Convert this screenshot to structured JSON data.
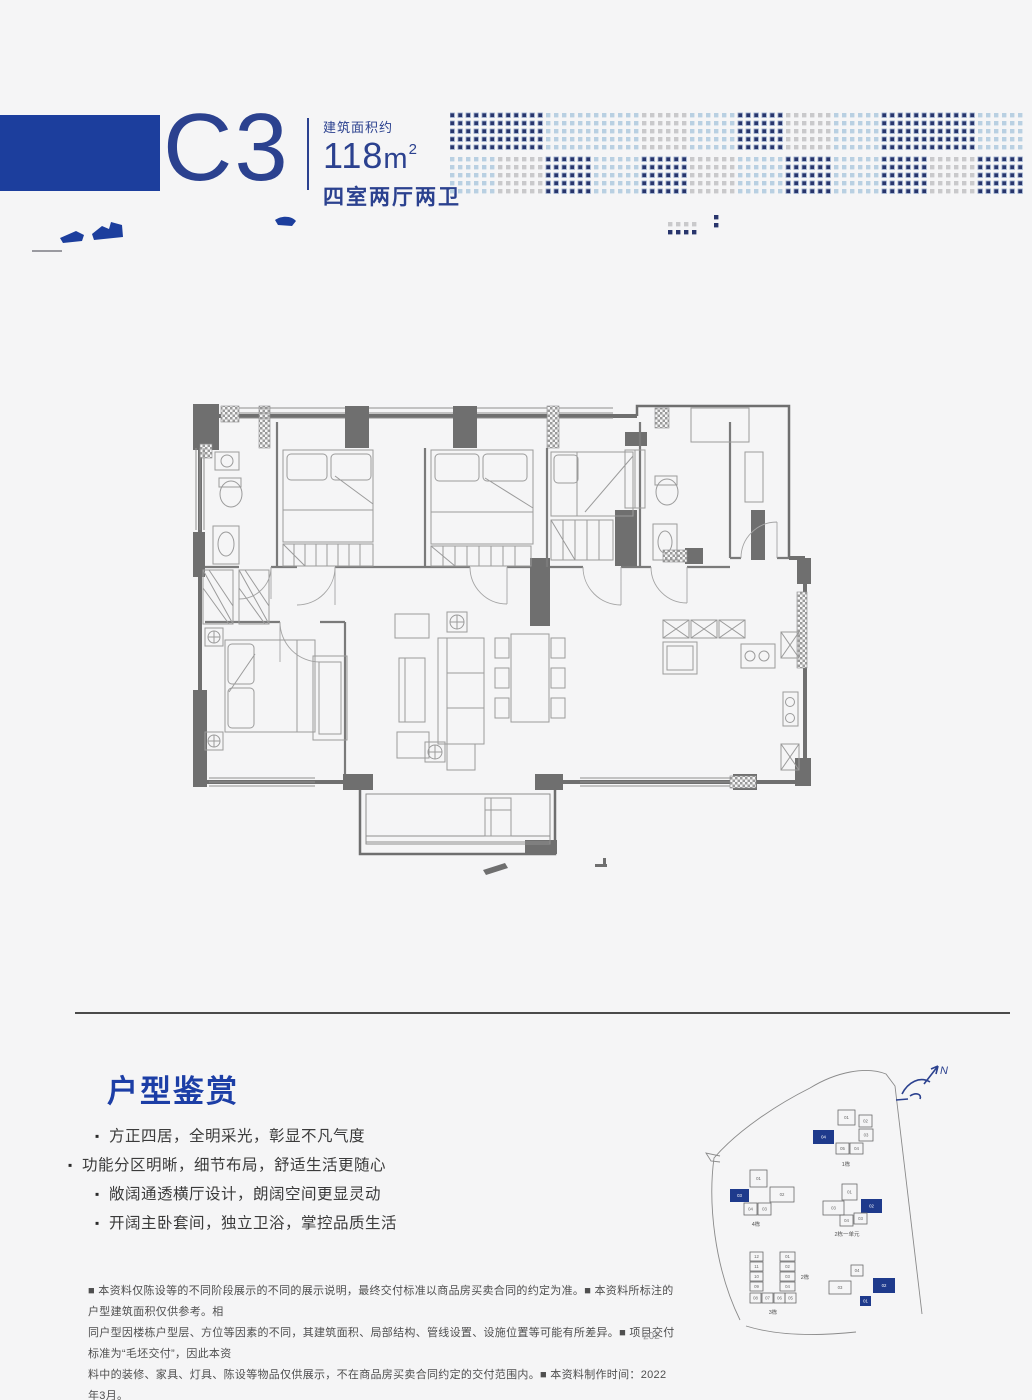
{
  "header": {
    "unit_code": "C3",
    "area_label": "建筑面积约",
    "area_value": "118",
    "area_unit": "m",
    "area_sup": "2",
    "layout_label": "四室两厅两卫",
    "banner_color": "#1c3e9d",
    "text_color": "#2b418f"
  },
  "decor": {
    "dot_dark": "#28356c",
    "dot_halo": "#93a7c9",
    "dot_blue": "#b9d0e2",
    "dot_gray": "#c9c9cb",
    "top_band": [
      "d",
      "d",
      "b",
      "b",
      "g",
      "b",
      "d",
      "g",
      "b",
      "d",
      "d",
      "b"
    ],
    "bottom_band": [
      "b",
      "g",
      "d",
      "b",
      "d",
      "g",
      "b",
      "d",
      "b",
      "d",
      "g",
      "d"
    ],
    "extra_dots": [
      {
        "x": 218,
        "y": 112,
        "c": "g"
      },
      {
        "x": 226,
        "y": 112,
        "c": "g"
      },
      {
        "x": 234,
        "y": 112,
        "c": "g"
      },
      {
        "x": 242,
        "y": 112,
        "c": "g"
      },
      {
        "x": 218,
        "y": 120,
        "c": "d"
      },
      {
        "x": 226,
        "y": 120,
        "c": "d"
      },
      {
        "x": 234,
        "y": 120,
        "c": "d"
      },
      {
        "x": 242,
        "y": 120,
        "c": "d"
      },
      {
        "x": 264,
        "y": 105,
        "c": "d"
      },
      {
        "x": 264,
        "y": 113,
        "c": "d"
      }
    ]
  },
  "appreciation": {
    "title": "户型鉴赏",
    "bullets": [
      "方正四居，全明采光，彰显不凡气度",
      "功能分区明晰，细节布局，舒适生活更随心",
      "敞阔通透横厅设计，朗阔空间更显灵动",
      "开阔主卧套间，独立卫浴，掌控品质生活"
    ]
  },
  "siteplan": {
    "north_label": "N",
    "outline_color": "#8a8a8a",
    "unit_stroke": "#6a6a6a",
    "unit_text_color": "#666666",
    "highlight_color": "#1e3a8c",
    "clusters": [
      {
        "label": "1栋",
        "ox": 115,
        "oy": 58,
        "lx": 33,
        "ly": 56,
        "units": [
          {
            "id": "01",
            "x": 25,
            "y": 0,
            "w": 17,
            "h": 15
          },
          {
            "id": "02",
            "x": 46,
            "y": 5,
            "w": 13,
            "h": 12
          },
          {
            "id": "03",
            "x": 46,
            "y": 19,
            "w": 14,
            "h": 12
          },
          {
            "id": "04",
            "x": 0,
            "y": 20,
            "w": 21,
            "h": 14,
            "hl": true
          },
          {
            "id": "05",
            "x": 23,
            "y": 33,
            "w": 13,
            "h": 11
          },
          {
            "id": "04",
            "x": 37,
            "y": 33,
            "w": 13,
            "h": 11
          }
        ]
      },
      {
        "label": "4栋",
        "ox": 32,
        "oy": 118,
        "lx": 26,
        "ly": 56,
        "units": [
          {
            "id": "01",
            "x": 20,
            "y": 0,
            "w": 17,
            "h": 17
          },
          {
            "id": "02",
            "x": 40,
            "y": 17,
            "w": 24,
            "h": 15
          },
          {
            "id": "03",
            "x": 0,
            "y": 19,
            "w": 19,
            "h": 13,
            "hl": true
          },
          {
            "id": "04",
            "x": 14,
            "y": 33,
            "w": 13,
            "h": 12
          },
          {
            "id": "03",
            "x": 28,
            "y": 33,
            "w": 13,
            "h": 12
          }
        ]
      },
      {
        "label": "2栋一单元",
        "ox": 125,
        "oy": 132,
        "lx": 24,
        "ly": 52,
        "units": [
          {
            "id": "01",
            "x": 19,
            "y": 0,
            "w": 15,
            "h": 16
          },
          {
            "id": "03",
            "x": 0,
            "y": 17,
            "w": 21,
            "h": 14
          },
          {
            "id": "02",
            "x": 38,
            "y": 15,
            "w": 21,
            "h": 14,
            "hl": true
          },
          {
            "id": "04",
            "x": 17,
            "y": 31,
            "w": 13,
            "h": 11
          },
          {
            "id": "03",
            "x": 31,
            "y": 29,
            "w": 13,
            "h": 11
          }
        ]
      },
      {
        "label": "3栋",
        "ox": 52,
        "oy": 200,
        "lx": 23,
        "ly": 62,
        "units": [
          {
            "id": "12",
            "x": 0,
            "y": 0,
            "w": 13,
            "h": 9
          },
          {
            "id": "11",
            "x": 0,
            "y": 10,
            "w": 13,
            "h": 9
          },
          {
            "id": "10",
            "x": 0,
            "y": 20,
            "w": 13,
            "h": 9
          },
          {
            "id": "09",
            "x": 0,
            "y": 30,
            "w": 13,
            "h": 9
          },
          {
            "id": "01",
            "x": 30,
            "y": 0,
            "w": 15,
            "h": 9
          },
          {
            "id": "02",
            "x": 30,
            "y": 10,
            "w": 15,
            "h": 9
          },
          {
            "id": "03",
            "x": 30,
            "y": 20,
            "w": 15,
            "h": 9
          },
          {
            "id": "04",
            "x": 30,
            "y": 30,
            "w": 15,
            "h": 9
          },
          {
            "id": "08",
            "x": 0,
            "y": 41,
            "w": 11,
            "h": 10
          },
          {
            "id": "07",
            "x": 12,
            "y": 41,
            "w": 11,
            "h": 10
          },
          {
            "id": "06",
            "x": 24,
            "y": 41,
            "w": 11,
            "h": 10
          },
          {
            "id": "05",
            "x": 35,
            "y": 41,
            "w": 11,
            "h": 10
          }
        ]
      },
      {
        "label": "2栋",
        "ox": 115,
        "oy": 205,
        "lx": -8,
        "ly": 22,
        "units": [
          {
            "id": "04",
            "x": 38,
            "y": 8,
            "w": 12,
            "h": 11
          },
          {
            "id": "03",
            "x": 16,
            "y": 24,
            "w": 22,
            "h": 13
          },
          {
            "id": "02",
            "x": 60,
            "y": 21,
            "w": 22,
            "h": 15,
            "hl": true
          },
          {
            "id": "01",
            "x": 47,
            "y": 39,
            "w": 11,
            "h": 10,
            "hl": true
          }
        ]
      }
    ]
  },
  "disclaimer": {
    "lines": [
      "■ 本资料仅陈设等的不同阶段展示的不同的展示说明，最终交付标准以商品房买卖合同的约定为准。■ 本资料所标注的户型建筑面积仅供参考。相",
      "同户型因楼栋户型层、方位等因素的不同，其建筑面积、局部结构、管线设置、设施位置等可能有所差异。■ 项目交付标准为“毛坯交付”，因此本资",
      "料中的装修、家具、灯具、陈设等物品仅供展示，不在商品房买卖合同约定的交付范围内。■ 本资料制作时间：2022年3月。"
    ],
    "artifact": "202"
  }
}
